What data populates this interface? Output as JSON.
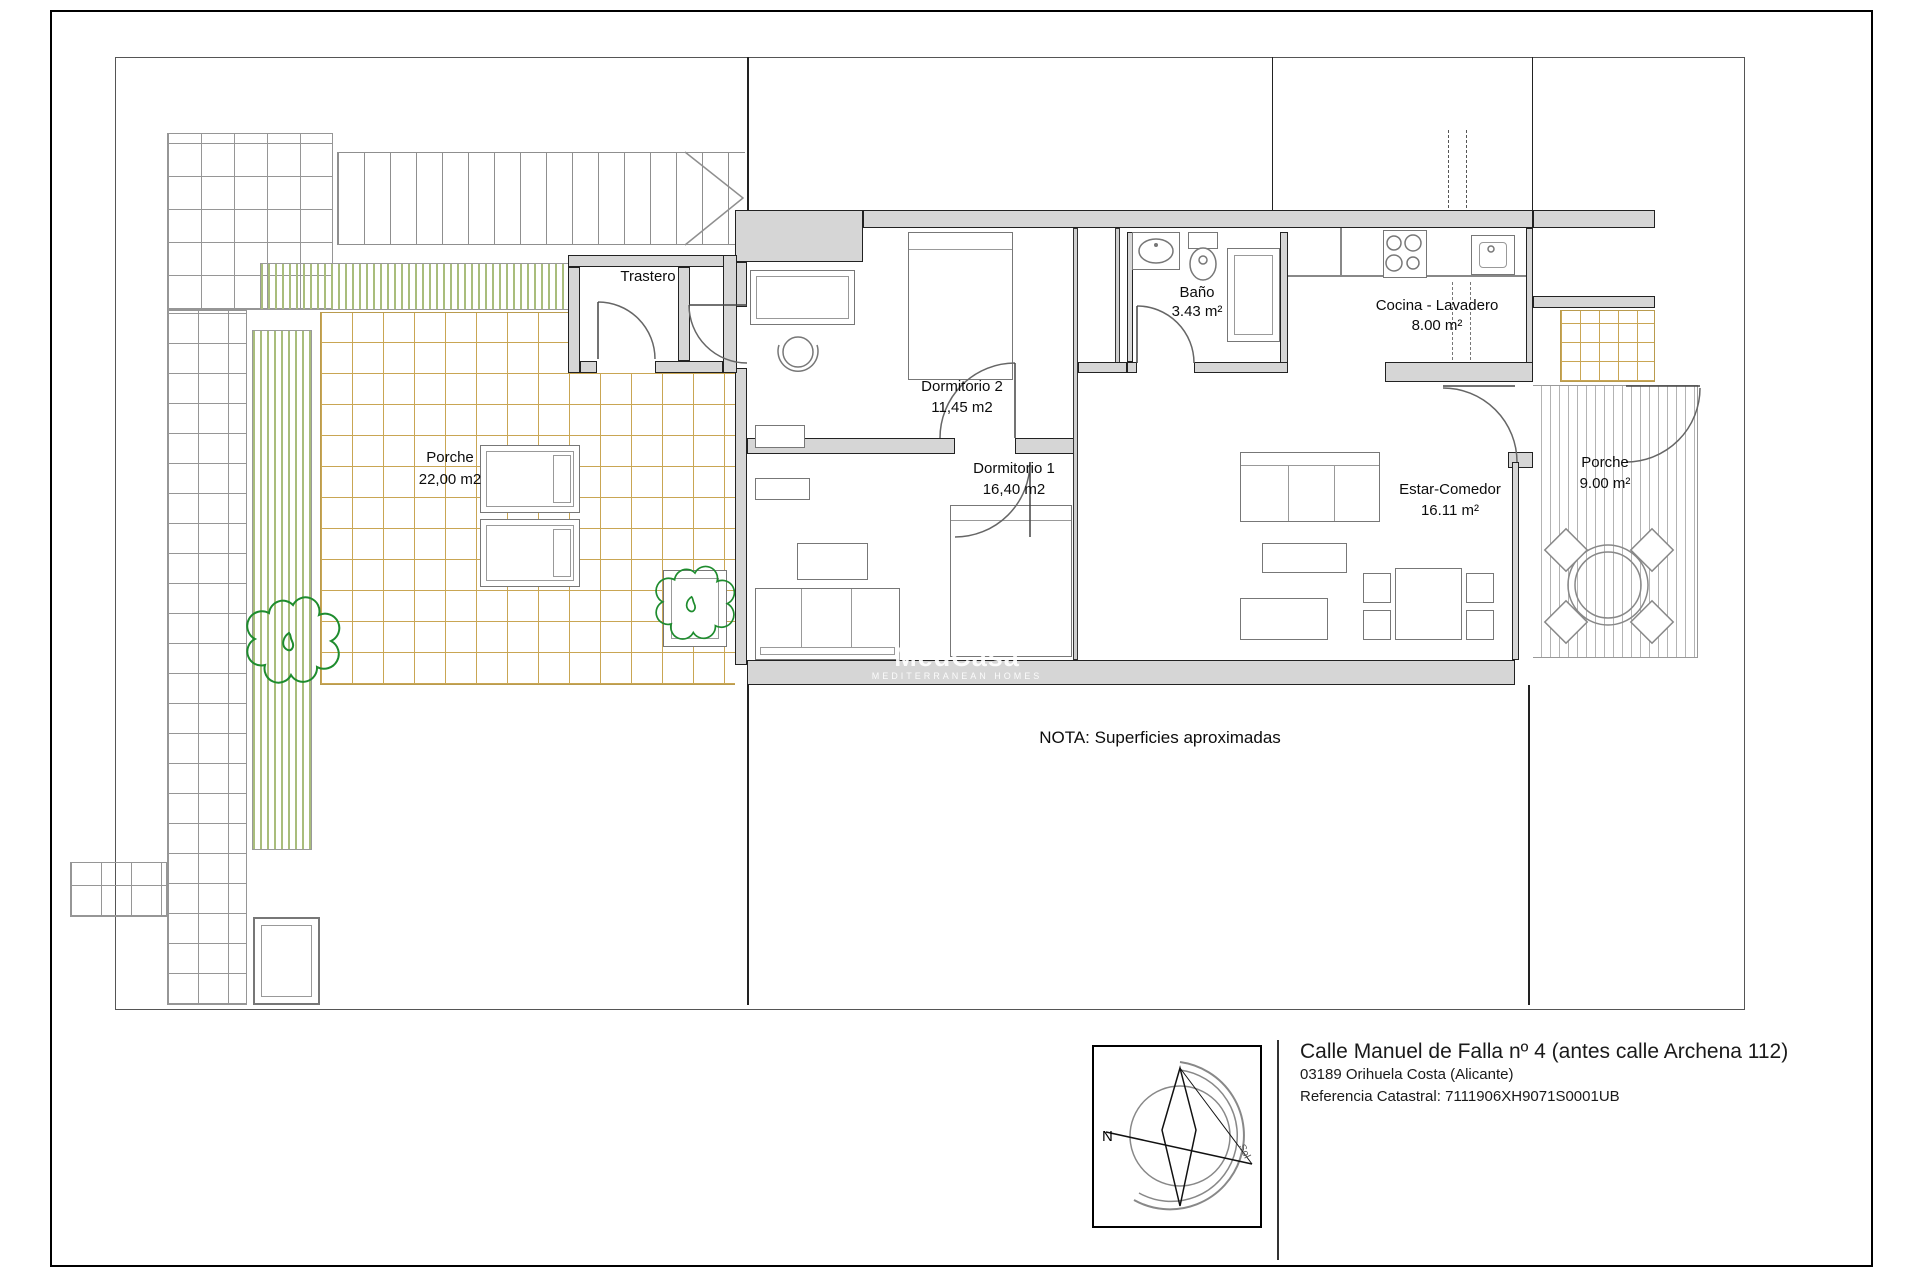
{
  "rooms": {
    "trastero": {
      "name": "Trastero"
    },
    "porche_izq": {
      "name": "Porche",
      "area": "22,00 m2"
    },
    "dormitorio2": {
      "name": "Dormitorio 2",
      "area": "11,45 m2"
    },
    "dormitorio1": {
      "name": "Dormitorio 1",
      "area": "16,40 m2"
    },
    "bano": {
      "name": "Baño",
      "area": "3.43 m²"
    },
    "cocina": {
      "name": "Cocina - Lavadero",
      "area": "8.00 m²"
    },
    "estar": {
      "name": "Estar-Comedor",
      "area": "16.11 m²"
    },
    "porche_der": {
      "name": "Porche",
      "area": "9.00 m²"
    }
  },
  "note": "NOTA: Superficies aproximadas",
  "watermark": {
    "brand": "MedCasa",
    "tagline": "MEDITERRANEAN HOMES"
  },
  "compass": {
    "north": "N",
    "sun": "Sol"
  },
  "footer": {
    "line1": "Calle Manuel de Falla nº 4 (antes calle Archena 112)",
    "line2": "03189 Orihuela Costa (Alicante)",
    "line3": "Referencia Catastral: 7111906XH9071S0001UB"
  },
  "colors": {
    "wall_fill": "#d6d6d6",
    "tile_tan": "#c9a654",
    "hedge_green": "#a9bd7c",
    "tree_green": "#1e8c2e",
    "grid_gray": "#969696"
  }
}
